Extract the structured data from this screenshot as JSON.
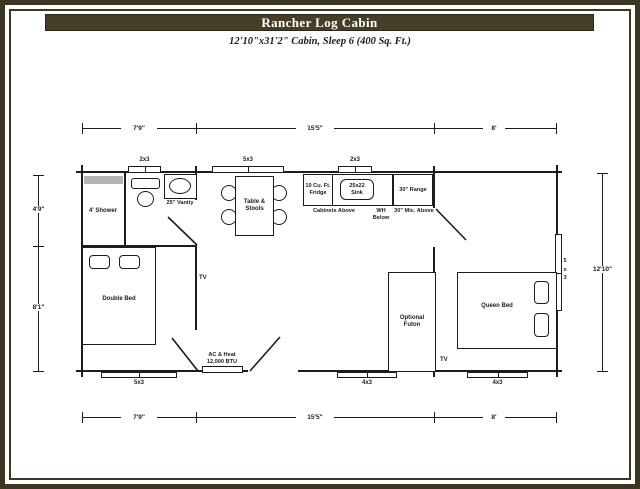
{
  "header": {
    "title": "Rancher Log Cabin",
    "subtitle": "12'10\"x31'2\" Cabin, Sleep 6 (400 Sq. Ft.)"
  },
  "dims": {
    "top": [
      {
        "label": "7'9\""
      },
      {
        "label": "15'5\""
      },
      {
        "label": "8'"
      }
    ],
    "bottom": [
      {
        "label": "7'9\""
      },
      {
        "label": "15'5\""
      },
      {
        "label": "8'"
      }
    ],
    "left": [
      {
        "label": "4'9\""
      },
      {
        "label": "8'1\""
      }
    ],
    "right": [
      {
        "label": "12'10\""
      }
    ]
  },
  "windows": {
    "bath_top": "2x3",
    "dining_top": "5x3",
    "kitchen_top": "2x3",
    "queen_right": "5x3",
    "bedroom_bottom": "5x3",
    "futon_bottom": "4x3",
    "queen_bottom": "4x3"
  },
  "fixtures": {
    "shower": "4' Shower",
    "vanity": "25\" Vanity",
    "table": "Table & Stools",
    "fridge": "10 Cu. Ft. Fridge",
    "sink": "25x22 Sink",
    "range": "30\" Range",
    "cabinets_above": "Cabinets Above",
    "wh_below": "WH Below",
    "mic_above": "30\" Mic. Above",
    "double_bed": "Double Bed",
    "queen_bed": "Queen Bed",
    "futon": "Optional Futon",
    "tv_living": "TV",
    "tv_queen": "TV",
    "ac_name": "AC & Heat",
    "ac_spec": "12,000 BTU"
  },
  "colors": {
    "frame": "#3c3623",
    "title_bg": "#443e27",
    "title_text": "#ffffff",
    "line": "#1c1c1c",
    "shower_strip": "#b4b4b4"
  }
}
